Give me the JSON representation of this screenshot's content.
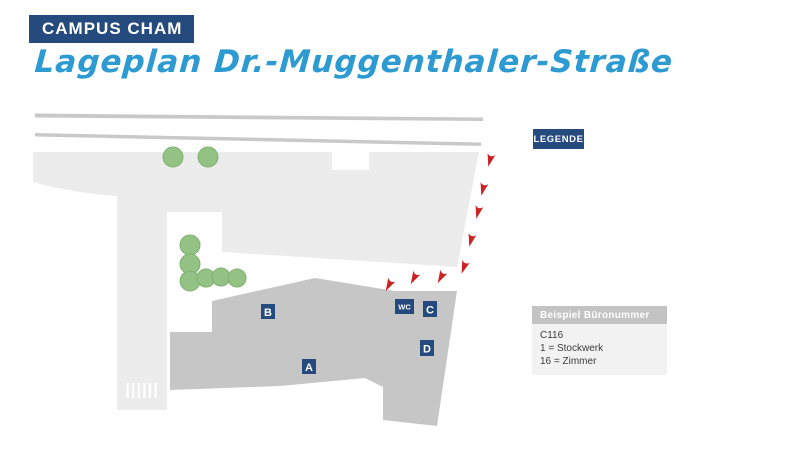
{
  "header": {
    "title": "CAMPUS CHAM",
    "subtitle": "Lageplan Dr.-Muggenthaler-Straße"
  },
  "legend_button": {
    "label": "LEGENDE"
  },
  "map": {
    "building_labels": {
      "a": "A",
      "b": "B",
      "c": "C",
      "d": "D",
      "wc": "WC"
    }
  },
  "legend_box": {
    "title": "Beispiel Büronummer",
    "lines": [
      "C116",
      "1 = Stockwerk",
      "16 = Zimmer"
    ]
  },
  "colors": {
    "navy": "#254a7d",
    "script_blue": "#2d9ad2",
    "street": "#ececec",
    "road_line": "#c9c9c9",
    "building": "#c6c6c6",
    "tree": "#93c284",
    "arrow_red": "#c92323",
    "legend_header": "#c3c3c3",
    "legend_body": "#f2f2f2"
  }
}
